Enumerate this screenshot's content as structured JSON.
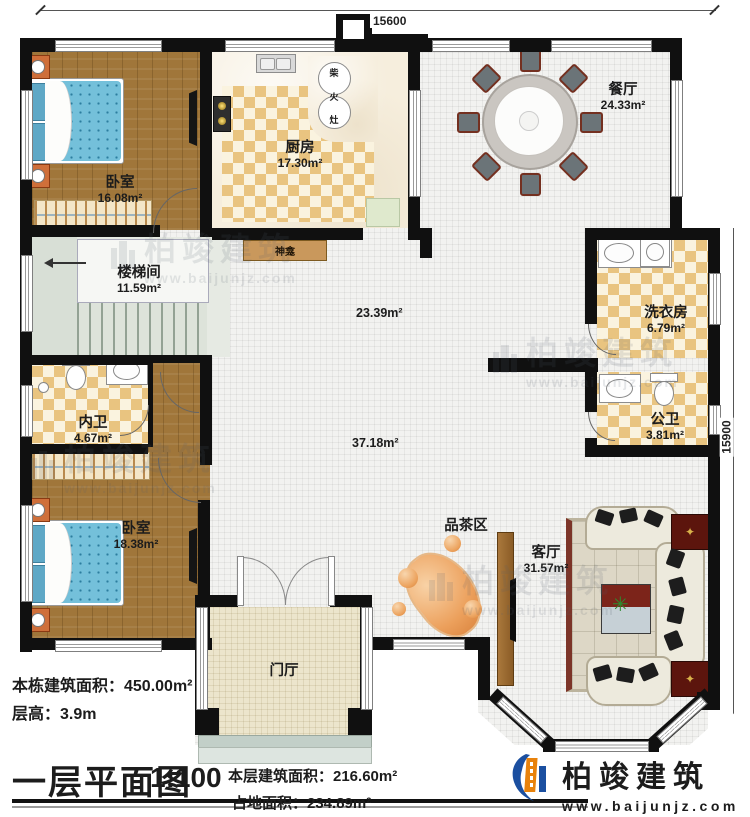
{
  "dims": {
    "top": "15600",
    "right": "15900"
  },
  "rooms": [
    {
      "id": "bedroom-1",
      "name": "卧室",
      "area": "16.08m²"
    },
    {
      "id": "kitchen",
      "name": "厨房",
      "area": "17.30m²"
    },
    {
      "id": "dining",
      "name": "餐厅",
      "area": "24.33m²"
    },
    {
      "id": "stairwell",
      "name": "楼梯间",
      "area": "11.59m²"
    },
    {
      "id": "laundry",
      "name": "洗衣房",
      "area": "6.79m²"
    },
    {
      "id": "bath-private",
      "name": "内卫",
      "area": "4.67m²"
    },
    {
      "id": "bath-public",
      "name": "公卫",
      "area": "3.81m²"
    },
    {
      "id": "bedroom-2",
      "name": "卧室",
      "area": "18.38m²"
    },
    {
      "id": "living",
      "name": "客厅",
      "area": "31.57m²"
    },
    {
      "id": "foyer",
      "name": "门厅"
    },
    {
      "id": "tea-area",
      "name": "品茶区"
    }
  ],
  "open_areas": {
    "upper": "23.39m²",
    "lower": "37.18m²"
  },
  "features": {
    "shrine": "神龛",
    "stove_chars": [
      "柴",
      "火",
      "灶"
    ]
  },
  "footer": {
    "building_total": "本栋建筑面积：450.00m²",
    "floor_height": "层高：3.9m",
    "title": "一层平面图",
    "scale": "1:100",
    "floor_area": "本层建筑面积：216.60m²",
    "footprint": "占地面积：234.89m²"
  },
  "brand": {
    "name": "柏竣建筑",
    "website": "www.baijunjz.com"
  },
  "colors": {
    "brand_blue": "#1b4fa0",
    "brand_orange": "#e8820c",
    "wall": "#101010"
  }
}
